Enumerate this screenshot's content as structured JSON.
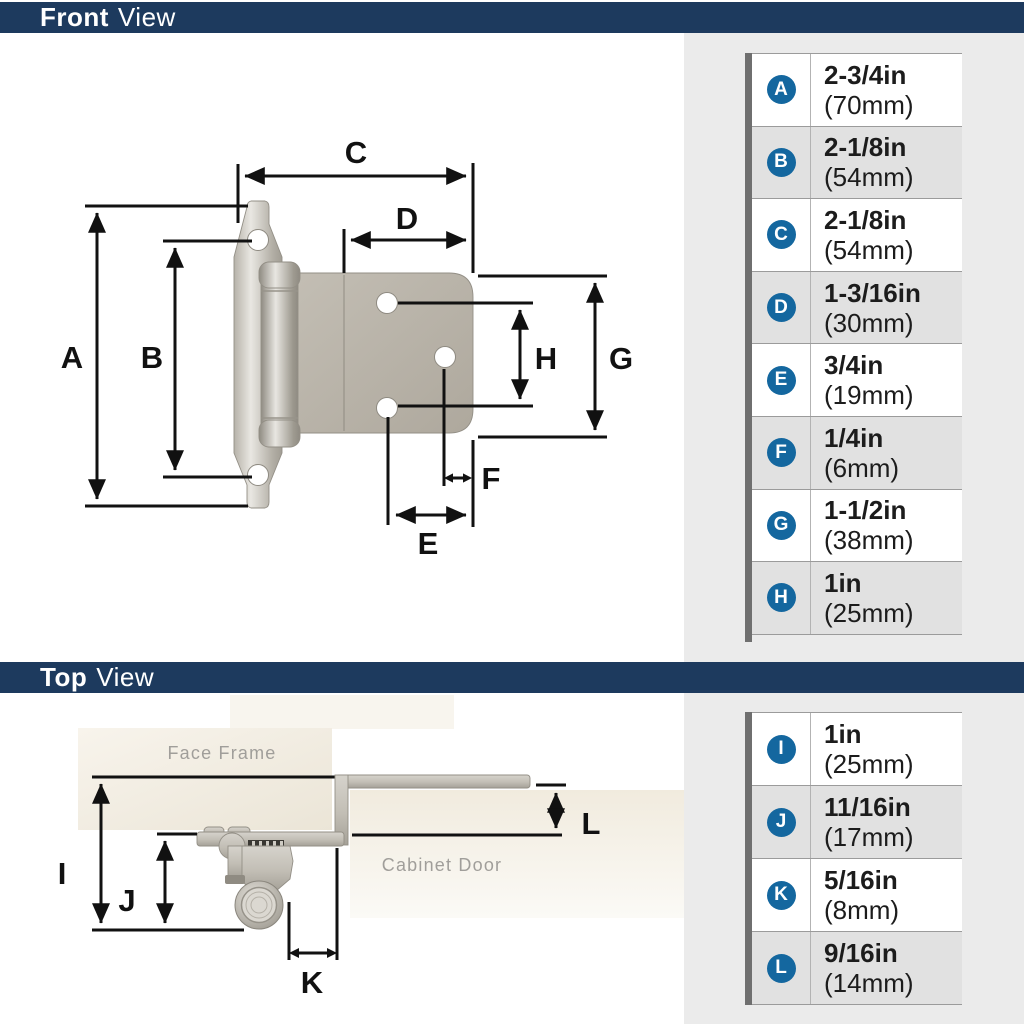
{
  "banners": {
    "front": {
      "bold": "Front",
      "regular": "View"
    },
    "top": {
      "bold": "Top",
      "regular": "View"
    }
  },
  "front_view": {
    "labels": {
      "A": "A",
      "B": "B",
      "C": "C",
      "D": "D",
      "E": "E",
      "F": "F",
      "G": "G",
      "H": "H"
    },
    "table": {
      "rows": [
        {
          "letter": "A",
          "inches": "2-3/4in",
          "mm": "(70mm)"
        },
        {
          "letter": "B",
          "inches": "2-1/8in",
          "mm": "(54mm)"
        },
        {
          "letter": "C",
          "inches": "2-1/8in",
          "mm": "(54mm)"
        },
        {
          "letter": "D",
          "inches": "1-3/16in",
          "mm": "(30mm)"
        },
        {
          "letter": "E",
          "inches": "3/4in",
          "mm": "(19mm)"
        },
        {
          "letter": "F",
          "inches": "1/4in",
          "mm": "(6mm)"
        },
        {
          "letter": "G",
          "inches": "1-1/2in",
          "mm": "(38mm)"
        },
        {
          "letter": "H",
          "inches": "1in",
          "mm": "(25mm)"
        }
      ]
    }
  },
  "top_view": {
    "labels": {
      "I": "I",
      "J": "J",
      "K": "K",
      "L": "L"
    },
    "annotations": {
      "face_frame": "Face Frame",
      "cabinet_door": "Cabinet Door"
    },
    "table": {
      "rows": [
        {
          "letter": "I",
          "inches": "1in",
          "mm": "(25mm)"
        },
        {
          "letter": "J",
          "inches": "11/16in",
          "mm": "(17mm)"
        },
        {
          "letter": "K",
          "inches": "5/16in",
          "mm": "(8mm)"
        },
        {
          "letter": "L",
          "inches": "9/16in",
          "mm": "(14mm)"
        }
      ]
    }
  },
  "colors": {
    "navy": "#1d3a5e",
    "badge_blue": "#14679f",
    "panel": "#ebebeb",
    "row_alt": "#e1e1e1",
    "bar": "#6f6f6f",
    "row_border": "#9b9b9b",
    "divider": "#b3b3b3",
    "text_dark": "#1c1c1c",
    "ink": "#111111",
    "muted": "#a09e9a"
  }
}
